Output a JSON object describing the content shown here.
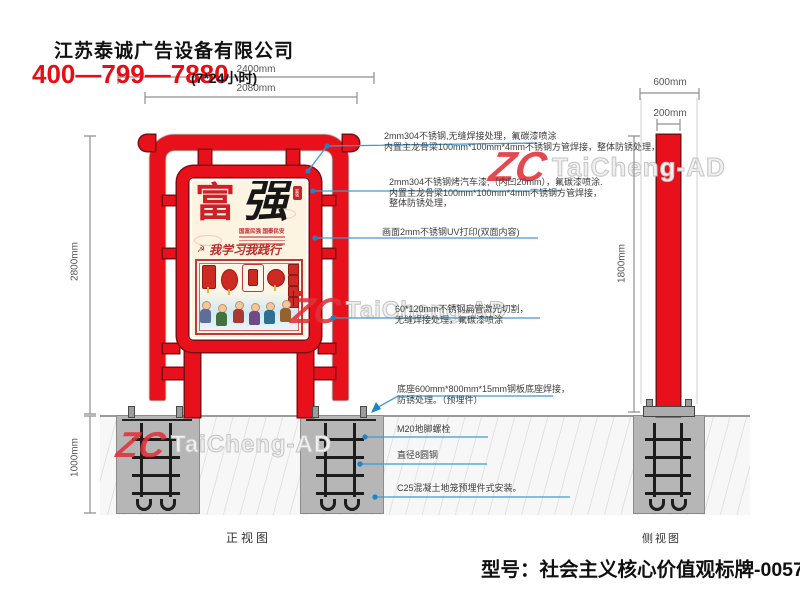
{
  "header": {
    "company": "江苏泰诚广告设备有限公司",
    "phone": "400—799—7880",
    "hours": "(7*24小时)"
  },
  "dims": {
    "w2400": "2400mm",
    "w2080": "2080mm",
    "h2800": "2800mm",
    "d1000": "1000mm",
    "s600": "600mm",
    "s200": "200mm",
    "s1800": "1800mm"
  },
  "annotations": {
    "a1l1": "2mm304不锈钢,无缝焊接处理，氟碳漆喷涂",
    "a1l2": "内置主龙骨梁100mm*100mm*4mm不锈钢方管焊接，整体防锈处理，",
    "a2l1": "2mm304不锈钢烤汽车漆,（内凹20mm），氟碳漆喷涂.",
    "a2l2": "内置主龙骨梁100mm*100mm*4mm不锈钢方管焊接，",
    "a2l3": "整体防锈处理，",
    "a3": "画面2mm不锈钢UV打印(双面内容)",
    "a4l1": "60*120mm不锈钢扁管激光切割，",
    "a4l2": "无缝焊接处理，氟碳漆喷涂",
    "a5l1": "底座600mm*800mm*15mm钢板底座焊接，",
    "a5l2": "防锈处理。（预埋件）",
    "a6": "M20地脚螺栓",
    "a7": "直径8圆钢",
    "a8": "C25混凝土地笼预埋件式安装。"
  },
  "views": {
    "front": "正视图",
    "side": "侧视图"
  },
  "poster": {
    "char1": "富",
    "char2": "强",
    "seal": "富强",
    "subtitle": "国富民强 国泰民安",
    "script": "我学习我践行",
    "emblem": "☭"
  },
  "watermark": {
    "logo": "ZC",
    "text": "TaiCheng-AD"
  },
  "footer": {
    "model": "型号：社会主义核心价值观标牌-0057"
  },
  "colors": {
    "red": "#e8111b",
    "dark_red": "#7d0d12",
    "blue": "#3d9bd4",
    "phone_red": "#e60d15"
  }
}
